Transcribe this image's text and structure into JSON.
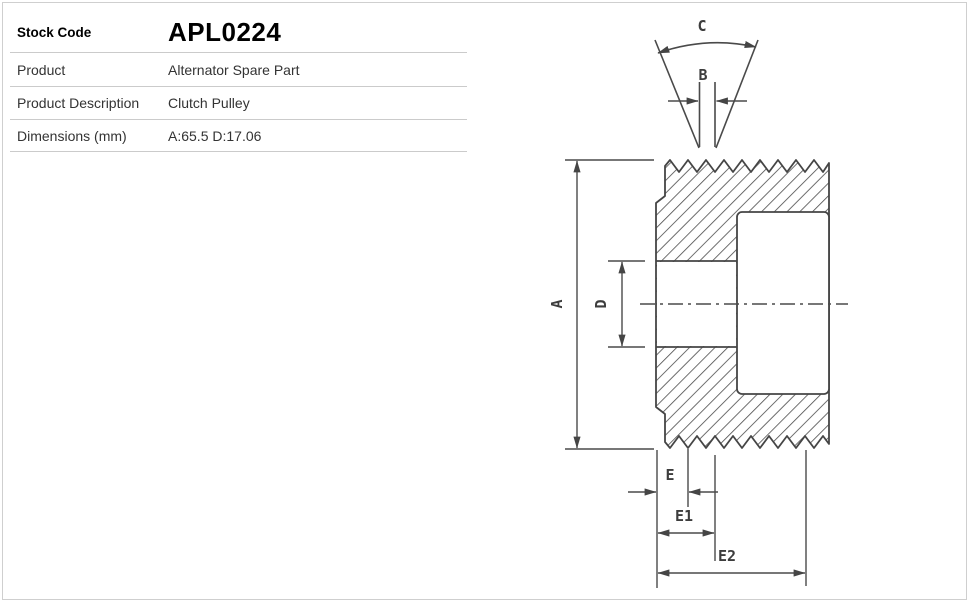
{
  "page": {
    "background": "#ffffff",
    "border_color": "#cfcfcf",
    "divider_color": "#cbcbcb"
  },
  "spec_table": {
    "rows": [
      {
        "label": "Stock Code",
        "value": "APL0224"
      },
      {
        "label": "Product",
        "value": "Alternator Spare Part"
      },
      {
        "label": "Product Description",
        "value": "Clutch Pulley"
      },
      {
        "label": "Dimensions (mm)",
        "value": "A:65.5 D:17.06"
      }
    ]
  },
  "drawing": {
    "description": "Clutch pulley cross-section technical drawing with poly-V ribbed surfaces, bore, bearing cavity and groove detail",
    "line_color": "#454545",
    "dimension_labels": {
      "a": "A",
      "b": "B",
      "c": "C",
      "d": "D",
      "e": "E",
      "e1": "E1",
      "e2": "E2"
    }
  }
}
